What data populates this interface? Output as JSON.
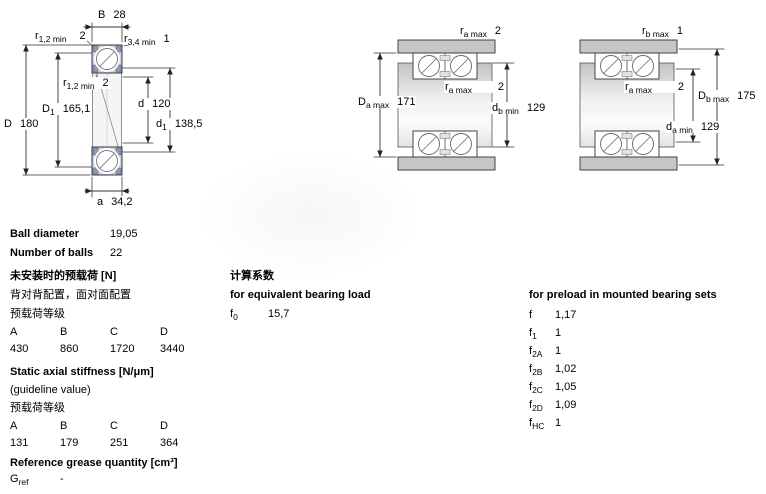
{
  "drawing1": {
    "labels": {
      "B": {
        "sym": "B",
        "val": "28"
      },
      "r12_top": {
        "sym": "r",
        "sub": "1,2 min",
        "val": "2"
      },
      "r34_top": {
        "sym": "r",
        "sub": "3,4 min",
        "val": "1"
      },
      "r12_mid": {
        "sym": "r",
        "sub": "1,2 min",
        "val": "2"
      },
      "D1": {
        "sym": "D",
        "sub": "1",
        "val": "165,1"
      },
      "D": {
        "sym": "D",
        "val": "180"
      },
      "d": {
        "sym": "d",
        "val": "120"
      },
      "d1": {
        "sym": "d",
        "sub": "1",
        "val": "138,5"
      },
      "a": {
        "sym": "a",
        "val": "34,2"
      }
    }
  },
  "drawing2": {
    "labels": {
      "ra_top": {
        "sym": "r",
        "sub": "a max",
        "val": "2"
      },
      "Da_max": {
        "sym": "D",
        "sub": "a max",
        "val": "171"
      },
      "ra_mid": {
        "sym": "r",
        "sub": "a max",
        "val": "2"
      },
      "db_min": {
        "sym": "d",
        "sub": "b min",
        "val": "129"
      }
    }
  },
  "drawing3": {
    "labels": {
      "rb_top": {
        "sym": "r",
        "sub": "b max",
        "val": "1"
      },
      "ra_mid": {
        "sym": "r",
        "sub": "a max",
        "val": "2"
      },
      "Db_max": {
        "sym": "D",
        "sub": "b max",
        "val": "175"
      },
      "da_min": {
        "sym": "d",
        "sub": "a min",
        "val": "129"
      }
    }
  },
  "colors": {
    "ring_fill": "#ccd4e2",
    "seal_fill": "#8c99b4",
    "housing_fill": "#c6c6c6",
    "line": "#333333"
  },
  "specs": {
    "ball_diameter_label": "Ball diameter",
    "ball_diameter_value": "19,05",
    "number_of_balls_label": "Number of balls",
    "number_of_balls_value": "22",
    "preload_unmounted": {
      "heading": "未安装时的预载荷 [N]",
      "subheading": "背对背配置，面对面配置",
      "class_label": "预载荷等级",
      "columns": [
        "A",
        "B",
        "C",
        "D"
      ],
      "values": [
        "430",
        "860",
        "1720",
        "3440"
      ]
    },
    "stiffness": {
      "heading": "Static axial stiffness [N/μm]",
      "note": "(guideline value)",
      "class_label": "预载荷等级",
      "columns": [
        "A",
        "B",
        "C",
        "D"
      ],
      "values": [
        "131",
        "179",
        "251",
        "364"
      ]
    },
    "grease": {
      "heading": "Reference grease quantity [cm³]",
      "sym": "G",
      "sub": "ref",
      "value": "-"
    },
    "calc": {
      "heading_cn": "计算系数",
      "equiv_heading": "for equivalent bearing load",
      "f0": {
        "sym": "f",
        "sub": "0",
        "value": "15,7"
      },
      "preload_heading": "for preload in mounted bearing sets",
      "factors": [
        {
          "sym": "f",
          "sub": "",
          "value": "1,17"
        },
        {
          "sym": "f",
          "sub": "1",
          "value": "1"
        },
        {
          "sym": "f",
          "sub": "2A",
          "value": "1"
        },
        {
          "sym": "f",
          "sub": "2B",
          "value": "1,02"
        },
        {
          "sym": "f",
          "sub": "2C",
          "value": "1,05"
        },
        {
          "sym": "f",
          "sub": "2D",
          "value": "1,09"
        },
        {
          "sym": "f",
          "sub": "HC",
          "value": "1"
        }
      ]
    }
  }
}
